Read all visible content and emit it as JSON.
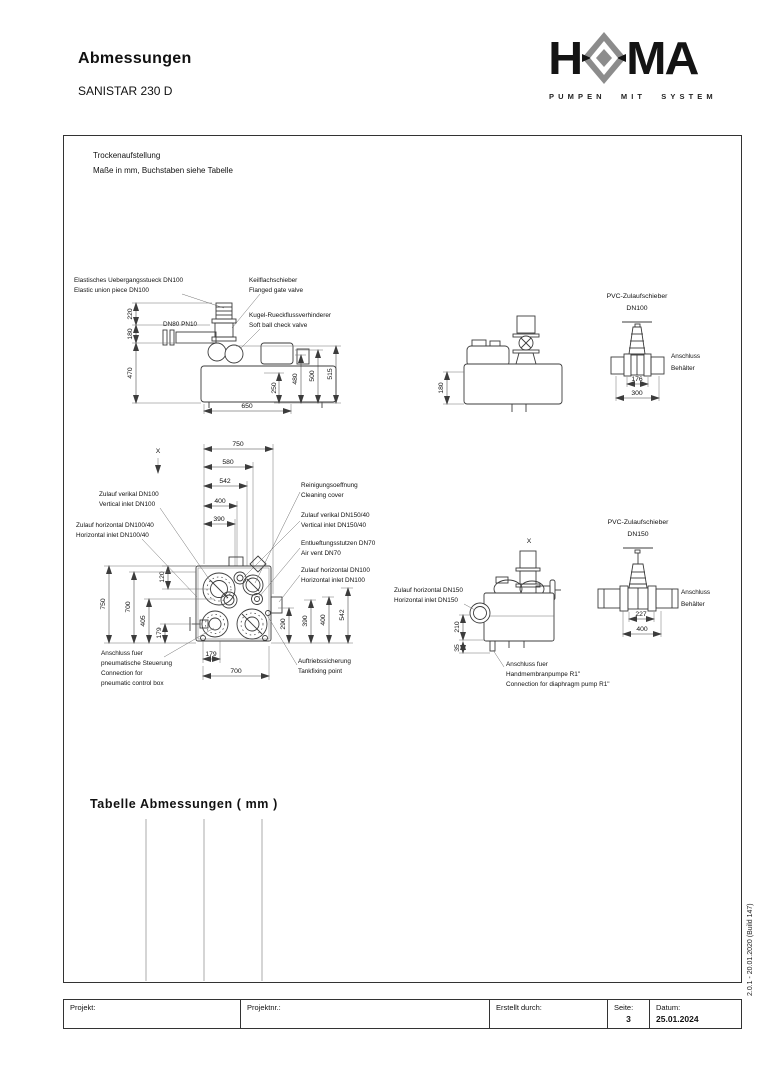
{
  "page": {
    "title": "Abmessungen",
    "subtitle": "SANISTAR 230 D"
  },
  "logo": {
    "h": "H",
    "ma": "MA",
    "tagline": "PUMPEN MIT SYSTEM",
    "diamond_color": "#8c8c8c"
  },
  "notes": {
    "line1": "Trockenaufstellung",
    "line2": "Maße in mm, Buchstaben siehe Tabelle"
  },
  "front_view": {
    "label_union_de": "Elastisches Uebergangsstueck DN100",
    "label_union_en": "Elastic union piece DN100",
    "label_gate_de": "Keilflachschieber",
    "label_gate_en": "Flanged gate valve",
    "label_check_de": "Kugel-Rueckflussverhinderer",
    "label_check_en": "Soft ball check valve",
    "label_dn80": "DN80 PN10",
    "dim_220": "220",
    "dim_180": "180",
    "dim_470": "470",
    "dim_250": "250",
    "dim_480": "480",
    "dim_500": "500",
    "dim_515": "515",
    "dim_650": "650"
  },
  "side_view": {
    "dim_180": "180"
  },
  "valve_dn100": {
    "title_de": "PVC-Zulaufschieber",
    "title_size": "DN100",
    "label_conn1": "Anschluss",
    "label_conn2": "Behälter",
    "dim_inner": "176",
    "dim_outer": "300"
  },
  "plan_view": {
    "marker": "X",
    "dim_750t": "750",
    "dim_580": "580",
    "dim_542t": "542",
    "dim_400t": "400",
    "dim_390t": "390",
    "dim_120": "120",
    "dim_750l": "750",
    "dim_700l": "700",
    "dim_405": "405",
    "dim_179l": "179",
    "dim_290": "290",
    "dim_390r": "390",
    "dim_400r": "400",
    "dim_542r": "542",
    "dim_179b": "179",
    "dim_700b": "700",
    "label_vert100_de": "Zulauf verikal DN100",
    "label_vert100_en": "Vertical inlet DN100",
    "label_horiz10040_de": "Zulauf horizontal DN100/40",
    "label_horiz10040_en": "Horizontal inlet DN100/40",
    "label_clean_de": "Reinigungsoeffnung",
    "label_clean_en": "Cleaning cover",
    "label_vert150_de": "Zulauf verikal DN150/40",
    "label_vert150_en": "Vertical inlet DN150/40",
    "label_vent_de": "Entlueftungsstutzen DN70",
    "label_vent_en": "Air vent DN70",
    "label_horiz100_de": "Zulauf horizontal DN100",
    "label_horiz100_en": "Horizontal inlet DN100",
    "label_pneu1": "Anschluss fuer",
    "label_pneu2": "pneumatische Steuerung",
    "label_pneu3": "Connection for",
    "label_pneu4": "pneumatic control box",
    "label_fix_de": "Auftriebssicherung",
    "label_fix_en": "Tankfixing point"
  },
  "side_view2": {
    "marker": "X",
    "dim_210": "210",
    "dim_35": "35",
    "label_horiz150_de": "Zulauf horizontal DN150",
    "label_horiz150_en": "Horizontal inlet DN150",
    "label_pump1": "Anschluss fuer",
    "label_pump2": "Handmembranpumpe R1\"",
    "label_pump3": "Connection for diaphragm pump R1\""
  },
  "valve_dn150": {
    "title_de": "PVC-Zulaufschieber",
    "title_size": "DN150",
    "label_conn1": "Anschluss",
    "label_conn2": "Behälter",
    "dim_inner": "227",
    "dim_outer": "400"
  },
  "table_section": {
    "title": "Tabelle Abmessungen  ( mm )"
  },
  "footer": {
    "projekt": "Projekt:",
    "projektnr": "Projektnr.:",
    "erstellt": "Erstellt durch:",
    "seite_label": "Seite:",
    "seite_value": "3",
    "datum_label": "Datum:",
    "datum_value": "25.01.2024"
  },
  "version": "2.0.1 - 20.01.2020 (Build 147)"
}
